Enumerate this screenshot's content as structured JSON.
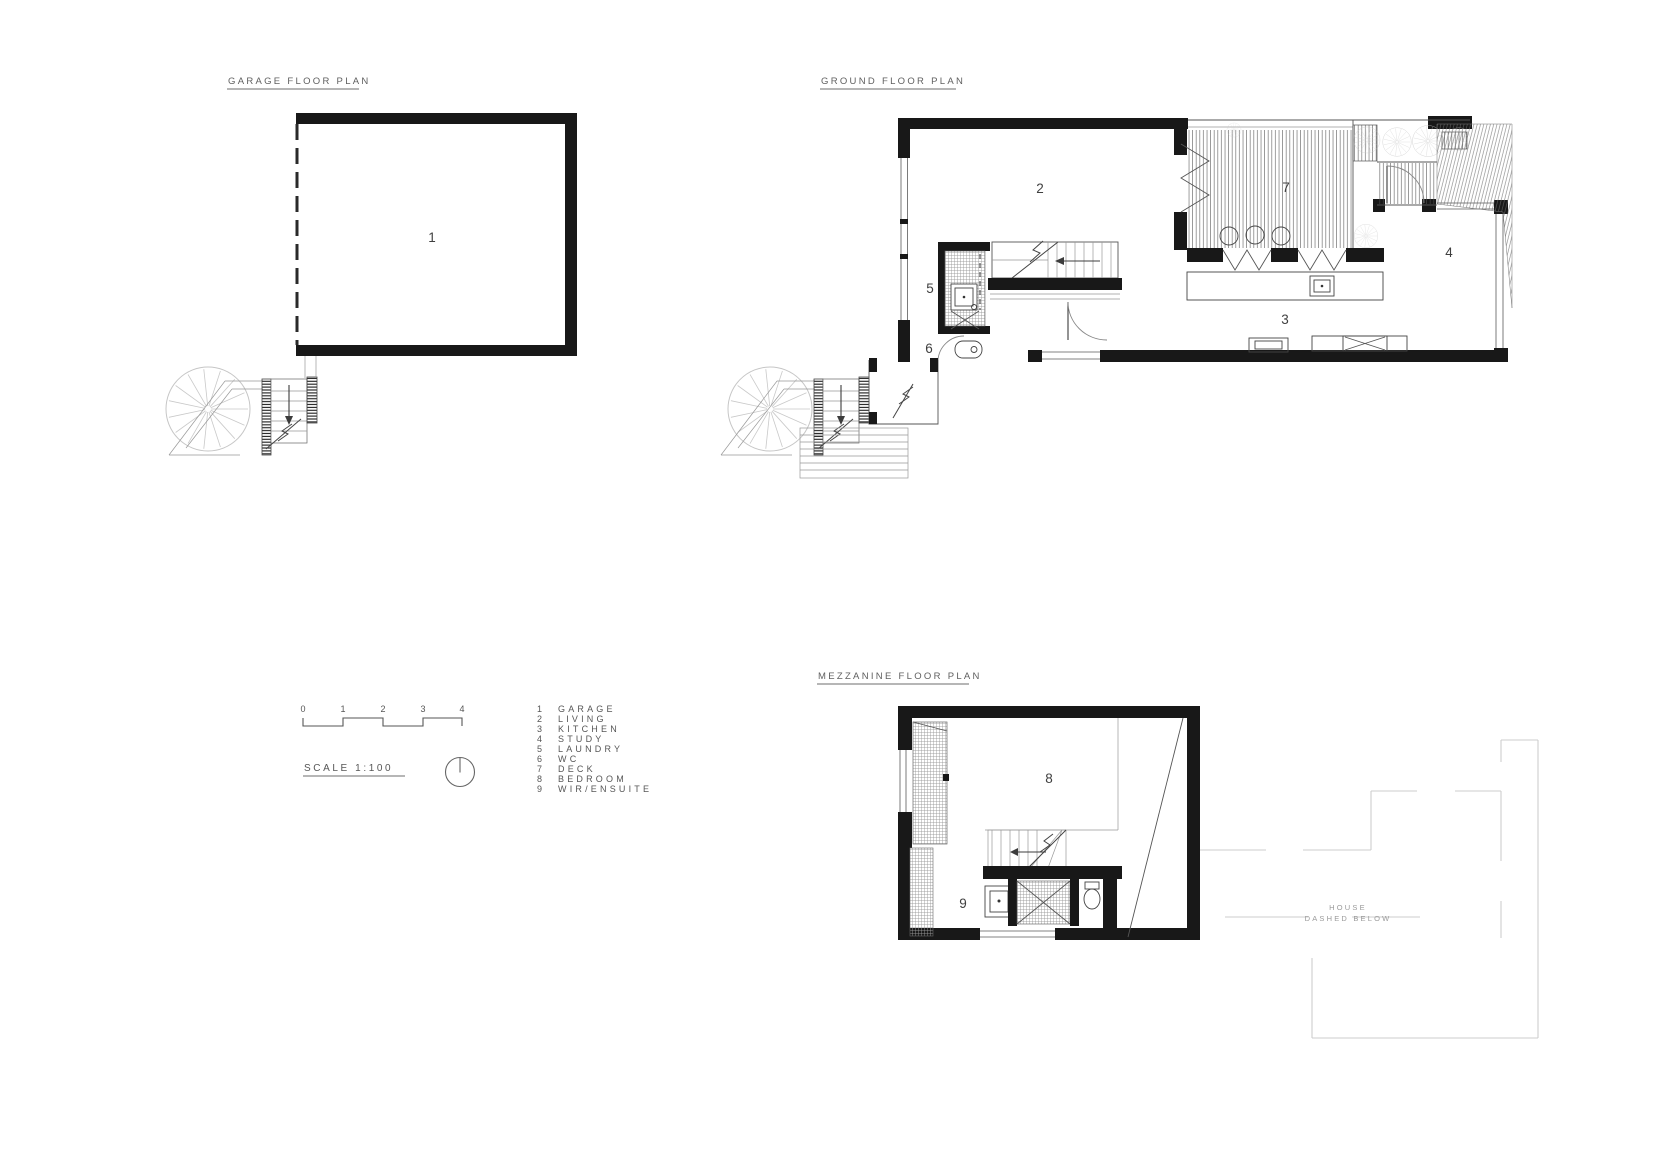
{
  "titles": {
    "garage": "GARAGE FLOOR PLAN",
    "ground": "GROUND FLOOR PLAN",
    "mezzanine": "MEZZANINE FLOOR PLAN"
  },
  "rooms": {
    "garage": "1",
    "living": "2",
    "kitchen": "3",
    "study": "4",
    "laundry": "5",
    "wc": "6",
    "deck": "7",
    "bedroom": "8",
    "wir_ensuite": "9"
  },
  "legend": {
    "items": [
      {
        "num": "1",
        "label": "GARAGE"
      },
      {
        "num": "2",
        "label": "LIVING"
      },
      {
        "num": "3",
        "label": "KITCHEN"
      },
      {
        "num": "4",
        "label": "STUDY"
      },
      {
        "num": "5",
        "label": "LAUNDRY"
      },
      {
        "num": "6",
        "label": "WC"
      },
      {
        "num": "7",
        "label": "DECK"
      },
      {
        "num": "8",
        "label": "BEDROOM"
      },
      {
        "num": "9",
        "label": "WIR/ENSUITE"
      }
    ]
  },
  "scalebar": {
    "label": "SCALE 1:100",
    "ticks": [
      "0",
      "1",
      "2",
      "3",
      "4"
    ]
  },
  "notes": {
    "house_dashed_1": "HOUSE",
    "house_dashed_2": "DASHED BELOW"
  },
  "colors": {
    "paper": "#ffffff",
    "wall_ink": "#181818",
    "line_gray": "#555555",
    "light_gray": "#cdcdcd",
    "tree_gray": "#c6c6c6"
  }
}
